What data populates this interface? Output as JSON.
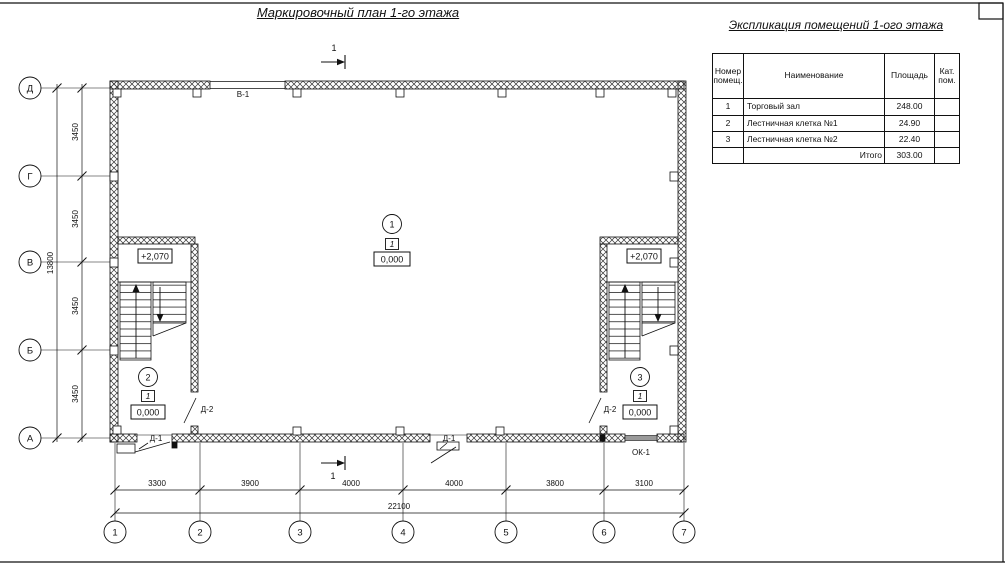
{
  "plan": {
    "title": "Маркировочный план 1-го этажа",
    "section_label": "1",
    "axis_letters": [
      "Д",
      "Г",
      "В",
      "Б",
      "А"
    ],
    "axis_numbers": [
      "1",
      "2",
      "3",
      "4",
      "5",
      "6",
      "7"
    ],
    "dims_left": [
      "3450",
      "3450",
      "3450",
      "3450"
    ],
    "dim_left_total": "13800",
    "dims_bottom": [
      "3300",
      "3900",
      "4000",
      "4000",
      "3800",
      "3100"
    ],
    "dim_bottom_total": "22100",
    "marks": {
      "window_top": "В-1",
      "window_bottom": "ОК-1",
      "door_outer": "Д-1",
      "door_inner": "Д-2",
      "level_upper": "+2,070"
    },
    "rooms": [
      {
        "number": "1",
        "category": "1",
        "level": "0,000"
      },
      {
        "number": "2",
        "category": "1",
        "level": "0,000"
      },
      {
        "number": "3",
        "category": "1",
        "level": "0,000"
      }
    ]
  },
  "explication": {
    "title": "Экспликация помещений 1-ого этажа",
    "headers": {
      "number": "Номер помещ.",
      "name": "Наименование",
      "area": "Площадь",
      "category": "Кат. пом."
    },
    "rows": [
      {
        "number": "1",
        "name": "Торговый зал",
        "area": "248.00",
        "category": ""
      },
      {
        "number": "2",
        "name": "Лестничная клетка №1",
        "area": "24.90",
        "category": ""
      },
      {
        "number": "3",
        "name": "Лестничная клетка №2",
        "area": "22.40",
        "category": ""
      }
    ],
    "total": {
      "label": "Итого",
      "area": "303.00"
    }
  }
}
